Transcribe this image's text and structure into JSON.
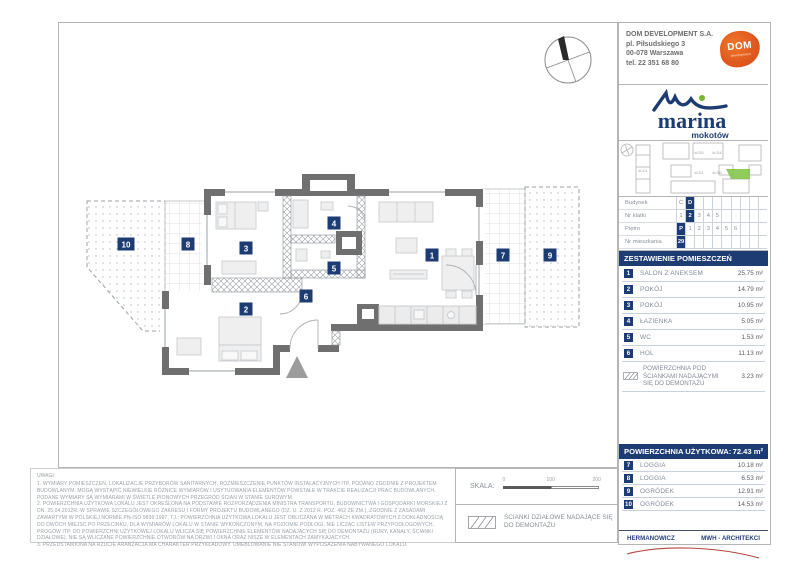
{
  "developer": {
    "name": "DOM DEVELOPMENT S.A.",
    "address_line1": "pl. Piłsudskiego 3",
    "address_line2": "00-078 Warszawa",
    "phone": "tel. 22 351 68 80",
    "logo_text": "DOM",
    "logo_subtext": "development"
  },
  "brand": {
    "name": "marina",
    "subname": "mokotów"
  },
  "site_plan": {
    "labels": [
      "kl.C1",
      "kl.D5",
      "kl.D4",
      "kl.D1",
      "kl.D6"
    ]
  },
  "unit_table": {
    "rows": [
      {
        "label": "Budynek",
        "cells": [
          "C",
          "D",
          "",
          "",
          "",
          "",
          "",
          "",
          "",
          ""
        ],
        "selected": 1
      },
      {
        "label": "Nr klatki",
        "cells": [
          "1",
          "2",
          "3",
          "4",
          "5",
          "",
          "",
          "",
          "",
          ""
        ],
        "selected": 1
      },
      {
        "label": "Piętro",
        "cells": [
          "P",
          "1",
          "2",
          "3",
          "4",
          "5",
          "6",
          "",
          "",
          ""
        ],
        "selected": 0
      },
      {
        "label": "Nr mieszkania",
        "cells": [
          "29",
          "",
          "",
          "",
          "",
          "",
          "",
          "",
          "",
          ""
        ],
        "selected": 0
      }
    ]
  },
  "rooms_header": "ZESTAWIENIE POMIESZCZEŃ",
  "rooms": [
    {
      "num": "1",
      "name": "SALON Z ANEKSEM",
      "area": "25.75 m²"
    },
    {
      "num": "2",
      "name": "POKÓJ",
      "area": "14.79 m²"
    },
    {
      "num": "3",
      "name": "POKÓJ",
      "area": "10.95 m²"
    },
    {
      "num": "4",
      "name": "ŁAZIENKA",
      "area": "5.05 m²"
    },
    {
      "num": "5",
      "name": "WC",
      "area": "1.53 m²"
    },
    {
      "num": "6",
      "name": "HOL",
      "area": "11.13 m²"
    }
  ],
  "demontaz": {
    "name": "POWIERZCHNIA POD\nŚCIANKAMI NADAJĄCYMI\nSIĘ DO DEMONTAŻU",
    "area": "3.23 m²"
  },
  "usable_area": {
    "label": "POWIERZCHNIA UŻYTKOWA:",
    "value": "72.43 m²"
  },
  "outdoor": [
    {
      "num": "7",
      "name": "LOGGIA",
      "area": "10.18 m²"
    },
    {
      "num": "8",
      "name": "LOGGIA",
      "area": "6.53 m²"
    },
    {
      "num": "9",
      "name": "OGRÓDEK",
      "area": "12.91 m²"
    },
    {
      "num": "10",
      "name": "OGRÓDEK",
      "area": "14.53 m²"
    }
  ],
  "architects": {
    "left": "HERMANOWICZ",
    "right": "MWH - ARCHITEKCI"
  },
  "notes": {
    "title": "UWAGI:",
    "items": [
      "1. WYMIARY POMIESZCZEŃ, LOKALIZACJE PRZYBORÓW SANITARNYCH, ROZMIESZCZENIE PUNKTÓW INSTALACYJNYCH ITP. PODANO ZGODNIE Z PROJEKTEM BUDOWLANYM. MOGĄ WYSTĄPIĆ NIEWIELKIE RÓŻNICE WYMIARÓW I USYTUOWANIA ELEMENTÓW POWSTAŁE W TRAKCIE REALIZACJI PRAC BUDOWLANYCH. PODANE WYMIARY SĄ WYMIARAMI W ŚWIETLE PIONOWYCH PRZEGRÓD ŚCIAN W STANIE SUROWYM.",
      "2. POWIERZCHNIA UŻYTKOWA LOKALU JEST OKREŚLONA NA PODSTAWIE ROZPORZĄDZENIA MINISTRA TRANSPORTU, BUDOWNICTWA I GOSPODARKI MORSKIEJ Z DN. 25.04.2012R. W SPRAWIE SZCZEGÓŁOWEGO ZAKRESU I FORMY PROJEKTU BUDOWLANEGO (DZ. U. Z 2012 R. POZ. 462 ZE ZM.), ZGODNIE Z ZASADAMI ZAWARTYMI W POLSKIEJ NORMIE PN-ISO 9836:1997, TJ.: POWIERZCHNIA UŻYTKOWA LOKALU JEST OBLICZANA W METRACH KWADRATOWYCH Z DOKŁADNOŚCIĄ DO DWÓCH MIEJSC PO PRZECINKU, DLA WYMIARÓW LOKALU W STANIE WYKOŃCZONYM, NA POZIOMIE PODŁOGI, NIE LICZĄC LISTEW PRZYPODŁOGOWYCH, PROGÓW ITP. DO POWIERZCHNI UŻYTKOWEJ LOKALU WLICZA SIĘ POWIERZCHNIE ELEMENTÓW NADAJĄCYCH SIĘ DO DEMONTAŻU (RURY, KANAŁY, ŚCIANKI DZIAŁOWE). NIE SĄ WLICZANE POWIERZCHNIE OTWORÓW NA DRZWI I OKNA ORAZ NISZE W ELEMENTACH ZAMYKAJĄCYCH.",
      "3. PRZEDSTAWIONA NA RZUCIE ARANŻACJA MA CHARAKTER PRZYKŁADOWY. UMEBLOWANIE NIE STANOWI WYPOSAŻENIA NABYWANEGO LOKALU."
    ]
  },
  "scale": {
    "label": "SKALA:",
    "ticks": [
      "0",
      "100",
      "200"
    ]
  },
  "legend": {
    "line1": "ŚCIANKI DZIAŁOWE NADAJĄCE SIĘ",
    "line2": "DO DEMONTAŻU"
  },
  "plan": {
    "labels": [
      "1",
      "2",
      "3",
      "4",
      "5",
      "6",
      "7",
      "8",
      "9",
      "10"
    ]
  },
  "colors": {
    "navy": "#1e3c74",
    "wall": "#6f6f6f",
    "orange": "#e05a1e",
    "green": "#76b82a",
    "signature_red": "#b4463c"
  }
}
